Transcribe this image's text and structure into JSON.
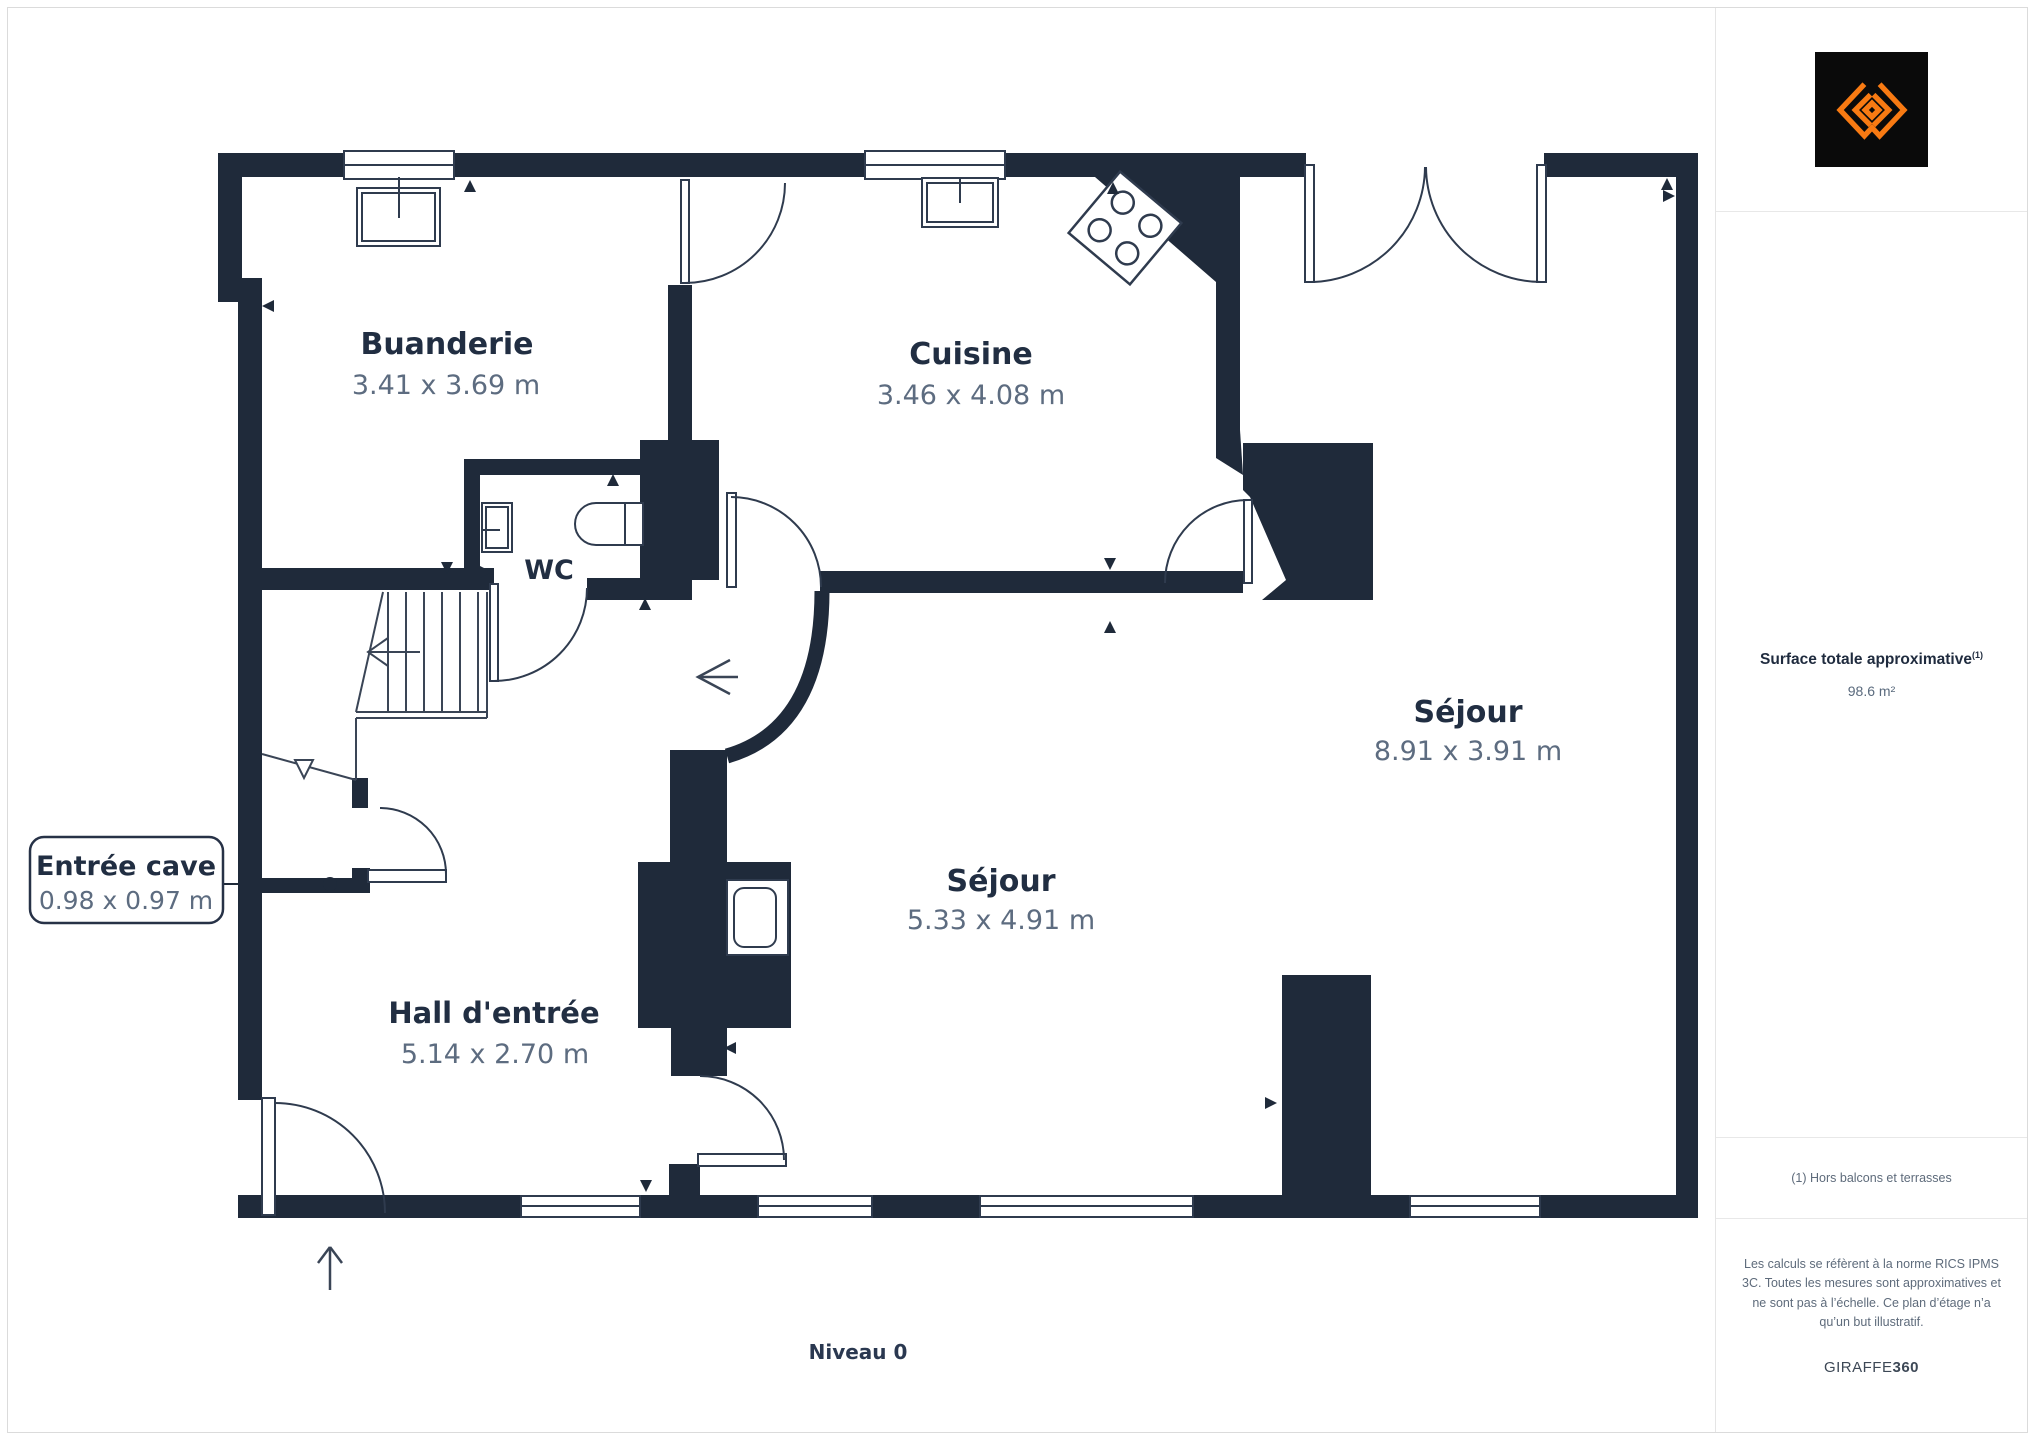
{
  "plan": {
    "level_label": "Niveau 0",
    "rooms": [
      {
        "name": "Buanderie",
        "dims": "3.41 x 3.69 m"
      },
      {
        "name": "Cuisine",
        "dims": "3.46 x 4.08 m"
      },
      {
        "name": "WC",
        "dims": ""
      },
      {
        "name": "Hall d'entrée",
        "dims": "5.14 x 2.70 m"
      },
      {
        "name": "Séjour",
        "dims": "5.33 x 4.91 m"
      },
      {
        "name": "Séjour",
        "dims": "8.91 x 3.91 m"
      },
      {
        "name": "Entrée cave",
        "dims": "0.98 x 0.97 m"
      }
    ]
  },
  "sidebar": {
    "logo": "giraffe360-logo",
    "surface_label": "Surface totale approximative",
    "surface_sup": "(1)",
    "surface_value": "98.6 m²",
    "note": "(1) Hors balcons et terrasses",
    "legal": "Les calculs se réfèrent à la norme RICS IPMS 3C. Toutes les mesures sont approximatives et ne sont pas à l’échelle. Ce plan d’étage n’a qu’un but illustratif.",
    "brand_regular": "GIRAFFE",
    "brand_bold": "360"
  },
  "colors": {
    "wall": "#1f2a3a",
    "thin_line": "#2f3b4e",
    "title_text": "#212e42",
    "dims_text": "#5d6c80",
    "accent_orange": "#f87a12"
  }
}
